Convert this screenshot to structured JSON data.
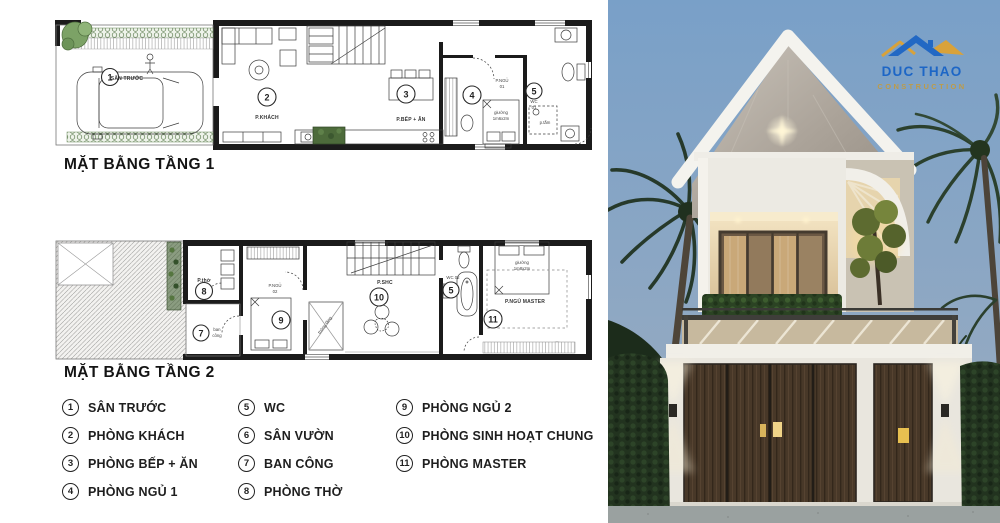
{
  "plan1": {
    "title": "MẶT BẰNG TẦNG 1",
    "annotations": {
      "n1": "1",
      "name1": "SÂN TRƯỚC",
      "n2": "2",
      "name2": "P.KHÁCH",
      "n3": "3",
      "name3": "P.BẾP + ĂN",
      "n4": "4",
      "name4_l1": "P.NGỦ",
      "name4_l2": "01",
      "n5": "5",
      "name5_l1": "WC",
      "name5_l2": "01",
      "bed_l1": "giường",
      "bed_l2": "1m6x2m",
      "bath": "p.tắm"
    }
  },
  "plan2": {
    "title": "MẶT BẰNG TẦNG 2",
    "annotations": {
      "n7": "7",
      "name7_l1": "ban",
      "name7_l2": "công",
      "n8": "8",
      "name8": "P.thờ",
      "n9": "9",
      "name9_l1": "P.NGỦ",
      "name9_l2": "02",
      "n10": "10",
      "name10": "P.SHC",
      "n5": "5",
      "name5": "WC 02",
      "n11": "11",
      "name11": "P.NGỦ MASTER",
      "bedm_l1": "giường",
      "bedm_l2": "1m8x2m",
      "void": "thông tầng"
    }
  },
  "legend": {
    "items": [
      {
        "num": "1",
        "label": "SÂN TRƯỚC"
      },
      {
        "num": "2",
        "label": "PHÒNG KHÁCH"
      },
      {
        "num": "3",
        "label": "PHÒNG BẾP + ĂN"
      },
      {
        "num": "4",
        "label": "PHÒNG NGỦ 1"
      },
      {
        "num": "5",
        "label": "WC"
      },
      {
        "num": "6",
        "label": "SÂN VƯỜN"
      },
      {
        "num": "7",
        "label": "BAN CÔNG"
      },
      {
        "num": "8",
        "label": "PHÒNG THỜ"
      },
      {
        "num": "9",
        "label": "PHÒNG NGỦ 2"
      },
      {
        "num": "10",
        "label": "PHÒNG SINH HOẠT CHUNG"
      },
      {
        "num": "11",
        "label": "PHÒNG MASTER"
      }
    ]
  },
  "logo": {
    "name": "DUC THAO",
    "subtitle": "CONSTRUCTION"
  },
  "colors": {
    "logo_blue": "#1d66c6",
    "logo_gold": "#c89a33",
    "sky": "#7ba0c6",
    "wood_door": "#473726",
    "hedge_green": "#22331f",
    "marble_gable": "#b3aca2"
  }
}
